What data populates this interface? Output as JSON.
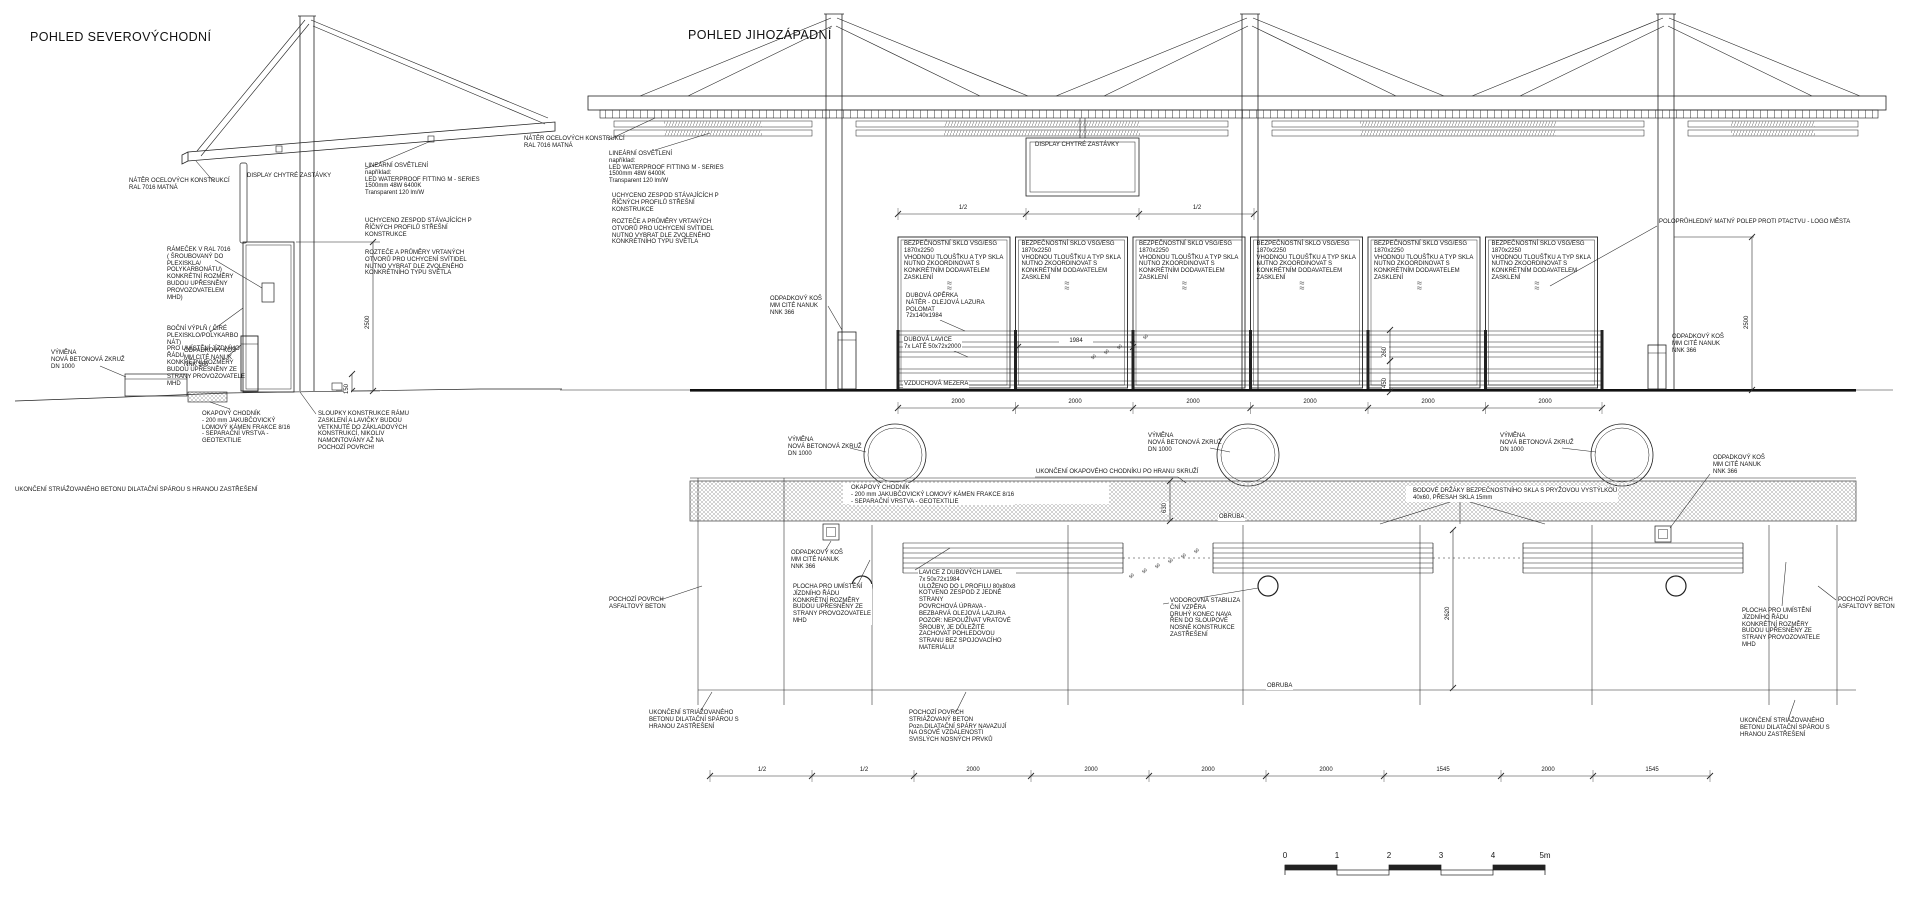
{
  "views": {
    "left": {
      "title": "POHLED SEVEROVÝCHODNÍ"
    },
    "right": {
      "title": "POHLED JIHOZÁPADNÍ"
    }
  },
  "glass_panels": {
    "count": 6,
    "x0": 898,
    "pitch": 117.5,
    "w": 112,
    "y": 237,
    "h": 151,
    "note": "BEZPEČNOSTNÍ SKLO VSG/ESG\n1870x2250\nVHODNOU TLOUŠŤKU A TYP SKLA\nNUTNO ZKOORDINOVAT S\nKONKRÉTNÍM DODAVATELEM\nZASKLENÍ",
    "symbol": "≈\n≈"
  },
  "labels": [
    {
      "x": 129,
      "y": 178,
      "t": "NÁTĚR OCELOVÝCH KONSTRUKCÍ\nRAL 7016 MATNÁ",
      "name": "note-steel-paint-ne"
    },
    {
      "x": 247,
      "y": 173,
      "t": "DISPLAY CHYTRÉ ZASTÁVKY",
      "name": "note-smart-display-ne"
    },
    {
      "x": 365,
      "y": 163,
      "t": "LINEÁRNÍ OSVĚTLENÍ\nnapříklad:\nLED WATERPROOF FITTING M - SERIES\n1500mm 48W 6400K\nTransparent 120 lm/W",
      "name": "note-linear-light-ne"
    },
    {
      "x": 365,
      "y": 218,
      "t": "UCHYCENO ZESPOD  STÁVAJÍCÍCH P\nŘÍČNÝCH PROFILŮ  STŘEŠNÍ\nKONSTRUKCE",
      "name": "note-fixing-ne"
    },
    {
      "x": 365,
      "y": 250,
      "t": "ROZTEČE A PRŮMĚRY VRTANÝCH\nOTVORŮ PRO UCHYCENÍ SVÍTIDEL\nNUTNO VYBRAT DLE ZVOLENÉHO\nKONKRÉTNÍHO TYPU SVĚTLA",
      "name": "note-drill-holes-ne"
    },
    {
      "x": 167,
      "y": 247,
      "t": "RÁMEČEK V RAL  7016\n( ŠROUBOVANÝ DO\nPLEXISKLA/\nPOLYKARBONÁTU)\nKONKRÉTNÍ ROZMĚRY\nBUDOU UPŘESNĚNY\nPROVOZOVATELEM\nMHD)",
      "name": "note-frame-ne"
    },
    {
      "x": 167,
      "y": 326,
      "t": "BOČNÍ VÝPLŇ ( ČIRÉ\nPLEXISKLO/POLYKARBO\nNÁT)\nPRO UMÍSTĚNÍ JÍZDNÍHO\nŘÁDU\nKONKRÉTNÍ ROZMĚRY\nBUDOU UPŘESNĚNY ZE\nSTRANY PROVOZOVATELE\nMHD",
      "name": "note-side-infill-ne"
    },
    {
      "x": 51,
      "y": 350,
      "t": "VÝMĚNA\nNOVÁ BETONOVÁ ZKRUŽ\nDN 1000",
      "name": "note-concrete-ring-ne"
    },
    {
      "x": 184,
      "y": 348,
      "t": "ODPADKOVÝ KOŠ\nMM CITÉ NANUK\nNNK 366",
      "name": "note-trash-bin-ne"
    },
    {
      "x": 202,
      "y": 411,
      "t": "OKAPOVÝ CHODNÍK\n- 200 mm JAKUBČOVICKÝ\nLOMOVÝ KÁMEN FRAKCE 8/16\n- SEPARAČNÍ VRSTVA -\nGEOTEXTILIE",
      "name": "note-drip-walk-ne"
    },
    {
      "x": 318,
      "y": 411,
      "t": "SLOUPKY KONSTRUKCE RÁMU\nZASKLENÍ A LAVIČKY BUDOU\nVETKNUTÉ DO ZÁKLADOVÝCH\nKONSTRUKCÍ, NIKOLIV\nNAMONTOVÁNY AŽ NA\nPOCHOZÍ POVRCH!",
      "name": "note-posts-ne"
    },
    {
      "x": 15,
      "y": 487,
      "t": "UKONČENÍ STRIÁŽOVANÉHO BETONU DILATAČNÍ SPÁROU S HRANOU ZASTŘEŠENÍ",
      "name": "note-concrete-edge-ne"
    },
    {
      "x": 524,
      "y": 136,
      "t": "NÁTĚR OCELOVÝCH KONSTRUKCÍ\nRAL 7016 MATNÁ",
      "name": "note-steel-paint-sw"
    },
    {
      "x": 609,
      "y": 151,
      "t": "LINEÁRNÍ OSVĚTLENÍ\nnapříklad:\nLED WATERPROOF FITTING M - SERIES\n1500mm 48W 6400K\nTransparent 120 lm/W",
      "name": "note-linear-light-sw"
    },
    {
      "x": 612,
      "y": 193,
      "t": "UCHYCENO ZESPOD  STÁVAJÍCÍCH P\nŘÍČNÝCH PROFILŮ  STŘEŠNÍ\nKONSTRUKCE",
      "name": "note-fixing-sw"
    },
    {
      "x": 612,
      "y": 219,
      "t": "ROZTEČE A PRŮMĚRY VRTANÝCH\nOTVORŮ PRO UCHYCENÍ SVÍTIDEL\nNUTNO VYBRAT DLE ZVOLENÉHO\nKONKRÉTNÍHO TYPU SVĚTLA",
      "name": "note-drill-holes-sw"
    },
    {
      "x": 1035,
      "y": 142,
      "t": "DISPLAY CHYTRÉ ZASTÁVKY",
      "name": "note-smart-display-sw"
    },
    {
      "x": 770,
      "y": 296,
      "t": "ODPADKOVÝ KOŠ\nMM CITÉ NANUK\nNNK 366",
      "name": "note-trash-bin-sw-left"
    },
    {
      "x": 905,
      "y": 293,
      "t": "DUBOVÁ OPĚRKA\nNÁTĚR - OLEJOVÁ LAZURA\nPOLOMAT\n72x140x1984",
      "bg": 1,
      "name": "note-oak-backrest"
    },
    {
      "x": 903,
      "y": 337,
      "t": "DUBOVÁ LAVICE\n7x LATĚ 50x72x2000",
      "bg": 1,
      "name": "note-oak-bench"
    },
    {
      "x": 903,
      "y": 381,
      "t": "VZDUCHOVÁ MEZERA",
      "bg": 1,
      "name": "note-air-gap"
    },
    {
      "x": 1659,
      "y": 219,
      "t": "POLOPRŮHLEDNÝ MATNÝ POLEP PROTI PTACTVU - LOGO MĚSTA",
      "name": "note-bird-foil"
    },
    {
      "x": 1672,
      "y": 334,
      "t": "ODPADKOVÝ KOŠ\nMM CITÉ NANUK\nNNK 366",
      "name": "note-trash-bin-sw-right"
    },
    {
      "x": 788,
      "y": 437,
      "t": "VÝMĚNA\nNOVÁ BETONOVÁ ZKRUŽ\nDN 1000",
      "name": "note-ring-1"
    },
    {
      "x": 1148,
      "y": 433,
      "t": "VÝMĚNA\nNOVÁ BETONOVÁ ZKRUŽ\nDN 1000",
      "name": "note-ring-2"
    },
    {
      "x": 1500,
      "y": 433,
      "t": "VÝMĚNA\nNOVÁ BETONOVÁ ZKRUŽ\nDN 1000",
      "name": "note-ring-3"
    },
    {
      "x": 1035,
      "y": 469,
      "t": "UKONČENÍ OKAPOVÉHO CHODNÍKU PO HRANU SKRUŽÍ",
      "bg": 1,
      "name": "note-walk-end"
    },
    {
      "x": 850,
      "y": 485,
      "t": "OKAPOVÝ CHODNÍK\n- 200 mm JAKUBČOVICKÝ LOMOVÝ KÁMEN FRAKCE 8/16\n- SEPARAČNÍ VRSTVA - GEOTEXTILIE",
      "bg": 1,
      "name": "note-drip-walk-sw"
    },
    {
      "x": 1412,
      "y": 488,
      "t": "BODOVÉ DRŽÁKY BEZPEČNOSTNÍHO SKLA S PRYŽOVOU VYSTÝLKOU\n40x60, PŘESAH SKLA 15mm",
      "bg": 1,
      "name": "note-point-holders"
    },
    {
      "x": 1218,
      "y": 514,
      "t": "OBRUBA",
      "bg": 1,
      "name": "note-curb-1"
    },
    {
      "x": 1266,
      "y": 683,
      "t": "OBRUBA",
      "bg": 1,
      "name": "note-curb-2"
    },
    {
      "x": 790,
      "y": 550,
      "t": "ODPADKOVÝ KOŠ\nMM CITÉ NANUK\nNNK 366",
      "bg": 1,
      "name": "note-trash-bin-plan"
    },
    {
      "x": 792,
      "y": 584,
      "t": "PLOCHA PRO UMÍSTĚNÍ\nJÍZDNÍHO ŘÁDU\nKONKRÉTNÍ ROZMĚRY\nBUDOU UPŘESNĚNY ZE\nSTRANY PROVOZOVATELE\nMHD",
      "bg": 1,
      "name": "note-timetable-left"
    },
    {
      "x": 918,
      "y": 570,
      "t": "LAVICE Z DUBOVÝCH LAMEL\n7x 50x72x1984\nULOŽENO DO L PROFILU 80x80x8\nKOTVENO ZESPOD Z JEDNÉ\nSTRANY\nPOVRCHOVÁ ÚPRAVA -\nBEZBARVÁ OLEJOVÁ LAZURA\nPOZOR: NEPOUŽÍVAT VRATOVÉ\nŠROUBY, JE DŮLEŽITÉ\nZACHOVAT POHLEDOVOU\nSTRANU BEZ SPOJOVACÍHO\nMATERIÁLU!",
      "bg": 1,
      "name": "note-oak-slats"
    },
    {
      "x": 1169,
      "y": 598,
      "t": "VODOROVNÁ STABILIZA\nČNÍ VZPĚRA\nDRUHÝ KONEC NAVA\nŘEN DO SLOUPOVÉ\nNOSNÉ KONSTRUKCE\nZASTŘEŠENÍ",
      "bg": 1,
      "name": "note-horizontal-brace"
    },
    {
      "x": 609,
      "y": 597,
      "t": "POCHOZÍ POVRCH\nASFALTOVÝ BETON",
      "name": "note-asphalt-left"
    },
    {
      "x": 1838,
      "y": 597,
      "t": "POCHOZÍ POVRCH\nASFALTOVÝ BETON",
      "name": "note-asphalt-right"
    },
    {
      "x": 649,
      "y": 710,
      "t": "UKONČENÍ STRIÁŽOVANÉHO\nBETONU DILATAČNÍ SPÁROU S\nHRANOU ZASTŘEŠENÍ",
      "name": "note-concrete-edge-sw-left"
    },
    {
      "x": 909,
      "y": 710,
      "t": "POCHOZÍ POVRCH\nSTRIÁŽOVANÝ BETON\nPozn.DILATAČNÍ SPÁRY NAVAZUJÍ\nNA OSOVÉ VZDÁLENOSTI\nSVISLÝCH NOSNÝCH PRVKŮ",
      "name": "note-striated-concrete"
    },
    {
      "x": 1740,
      "y": 718,
      "t": "UKONČENÍ STRIÁŽOVANÉHO\nBETONU DILATAČNÍ SPÁROU S\nHRANOU ZASTŘEŠENÍ",
      "name": "note-concrete-edge-sw-right"
    },
    {
      "x": 1742,
      "y": 608,
      "t": "PLOCHA PRO UMÍSTĚNÍ\nJÍZDNÍHO ŘÁDU\nKONKRÉTNÍ ROZMĚRY\nBUDOU UPŘESNĚNY ZE\nSTRANY PROVOZOVATELE\nMHD",
      "name": "note-timetable-right"
    },
    {
      "x": 1712,
      "y": 455,
      "t": "ODPADKOVÝ KOŠ\nMM CITÉ NANUK\nNNK 366",
      "bg": 1,
      "name": "note-trash-bin-plan-right"
    },
    {
      "x": 1090,
      "y": 357,
      "t": "50",
      "r": -48,
      "fs": 4.5
    },
    {
      "x": 1103,
      "y": 352,
      "t": "50",
      "r": -48,
      "fs": 4.5
    },
    {
      "x": 1116,
      "y": 347,
      "t": "50",
      "r": -48,
      "fs": 4.5
    },
    {
      "x": 1129,
      "y": 342,
      "t": "50",
      "r": -48,
      "fs": 4.5
    },
    {
      "x": 1142,
      "y": 337,
      "t": "50",
      "r": -48,
      "fs": 4.5
    },
    {
      "x": 1128,
      "y": 576,
      "t": "50",
      "r": -48,
      "fs": 4.5
    },
    {
      "x": 1141,
      "y": 571,
      "t": "50",
      "r": -48,
      "fs": 4.5
    },
    {
      "x": 1154,
      "y": 566,
      "t": "50",
      "r": -48,
      "fs": 4.5
    },
    {
      "x": 1167,
      "y": 561,
      "t": "50",
      "r": -48,
      "fs": 4.5
    },
    {
      "x": 1180,
      "y": 556,
      "t": "50",
      "r": -48,
      "fs": 4.5
    },
    {
      "x": 1193,
      "y": 551,
      "t": "50",
      "r": -48,
      "fs": 4.5
    }
  ],
  "dim_chains": [
    {
      "y": 214,
      "x1": 898,
      "x2": 1254,
      "ticks": [
        898,
        1026,
        1139,
        1254
      ],
      "labels": [
        {
          "x": 962,
          "t": "1/2"
        },
        {
          "x": 1196,
          "t": "1/2"
        }
      ]
    },
    {
      "y": 408,
      "x1": 898,
      "x2": 1602,
      "ticks": [
        898,
        1015.5,
        1133,
        1250.5,
        1368,
        1485.5,
        1602
      ],
      "labels": [
        {
          "x": 957,
          "t": "2000"
        },
        {
          "x": 1074,
          "t": "2000"
        },
        {
          "x": 1192,
          "t": "2000"
        },
        {
          "x": 1309,
          "t": "2000"
        },
        {
          "x": 1427,
          "t": "2000"
        },
        {
          "x": 1544,
          "t": "2000"
        }
      ]
    },
    {
      "y": 776,
      "x1": 710,
      "x2": 1710,
      "ticks": [
        710,
        812,
        914,
        1031,
        1149,
        1266,
        1384,
        1501,
        1593,
        1710
      ],
      "labels": [
        {
          "x": 761,
          "t": "1/2"
        },
        {
          "x": 863,
          "t": "1/2"
        },
        {
          "x": 972,
          "t": "2000"
        },
        {
          "x": 1090,
          "t": "2000"
        },
        {
          "x": 1207,
          "t": "2000"
        },
        {
          "x": 1325,
          "t": "2000"
        },
        {
          "x": 1442,
          "t": "1545"
        },
        {
          "x": 1547,
          "t": "2000"
        },
        {
          "x": 1651,
          "t": "1545"
        }
      ]
    },
    {
      "y": 347,
      "x1": 1018,
      "x2": 1133,
      "ticks": [
        1018,
        1133
      ],
      "labels": [
        {
          "x": 1075,
          "t": "1984"
        }
      ]
    }
  ],
  "v_dims": [
    {
      "x": 373,
      "y1": 242,
      "y2": 391,
      "t": "2500",
      "ty": 316
    },
    {
      "x": 352,
      "y1": 374,
      "y2": 391,
      "t": "150",
      "ty": 381
    },
    {
      "x": 1752,
      "y1": 237,
      "y2": 390,
      "t": "2500",
      "ty": 316
    },
    {
      "x": 1170,
      "y1": 481,
      "y2": 521,
      "t": "630",
      "ty": 500
    },
    {
      "x": 1453,
      "y1": 530,
      "y2": 688,
      "t": "2620",
      "ty": 607
    },
    {
      "x": 1390,
      "y1": 330,
      "y2": 361,
      "t": "260",
      "ty": 344
    },
    {
      "x": 1390,
      "y1": 361,
      "y2": 392,
      "t": "450",
      "ty": 375
    }
  ],
  "leaders": [
    [
      214,
      182,
      196,
      161
    ],
    [
      365,
      169,
      431,
      141
    ],
    [
      215,
      260,
      262,
      288
    ],
    [
      210,
      332,
      243,
      308
    ],
    [
      100,
      366,
      126,
      377
    ],
    [
      228,
      356,
      241,
      345
    ],
    [
      230,
      409,
      210,
      402
    ],
    [
      316,
      414,
      300,
      392
    ],
    [
      608,
      140,
      655,
      118
    ],
    [
      655,
      150,
      710,
      133
    ],
    [
      828,
      306,
      842,
      330
    ],
    [
      1657,
      226,
      1550,
      286
    ],
    [
      850,
      448,
      866,
      452
    ],
    [
      1210,
      448,
      1230,
      452
    ],
    [
      1562,
      448,
      1596,
      452
    ],
    [
      1035,
      477,
      1178,
      477
    ],
    [
      1178,
      477,
      1186,
      483
    ],
    [
      1450,
      502,
      1380,
      524
    ],
    [
      1470,
      502,
      1545,
      524
    ],
    [
      1460,
      502,
      1460,
      524
    ],
    [
      940,
      320,
      965,
      331
    ],
    [
      952,
      350,
      968,
      357
    ],
    [
      950,
      548,
      915,
      570
    ],
    [
      1163,
      604,
      1258,
      588
    ],
    [
      850,
      600,
      870,
      560
    ],
    [
      822,
      556,
      831,
      541
    ],
    [
      660,
      600,
      702,
      586
    ],
    [
      1836,
      600,
      1818,
      586
    ],
    [
      700,
      712,
      712,
      692
    ],
    [
      956,
      712,
      966,
      692
    ],
    [
      1788,
      720,
      1795,
      700
    ],
    [
      1710,
      474,
      1670,
      528
    ],
    [
      1782,
      606,
      1786,
      562
    ]
  ],
  "scale_bar": {
    "x": 1285,
    "y_num": 853,
    "y_bar": 865,
    "seg": 52,
    "h": 5,
    "ticks": [
      "0",
      "1",
      "2",
      "3",
      "4",
      "5m"
    ]
  }
}
